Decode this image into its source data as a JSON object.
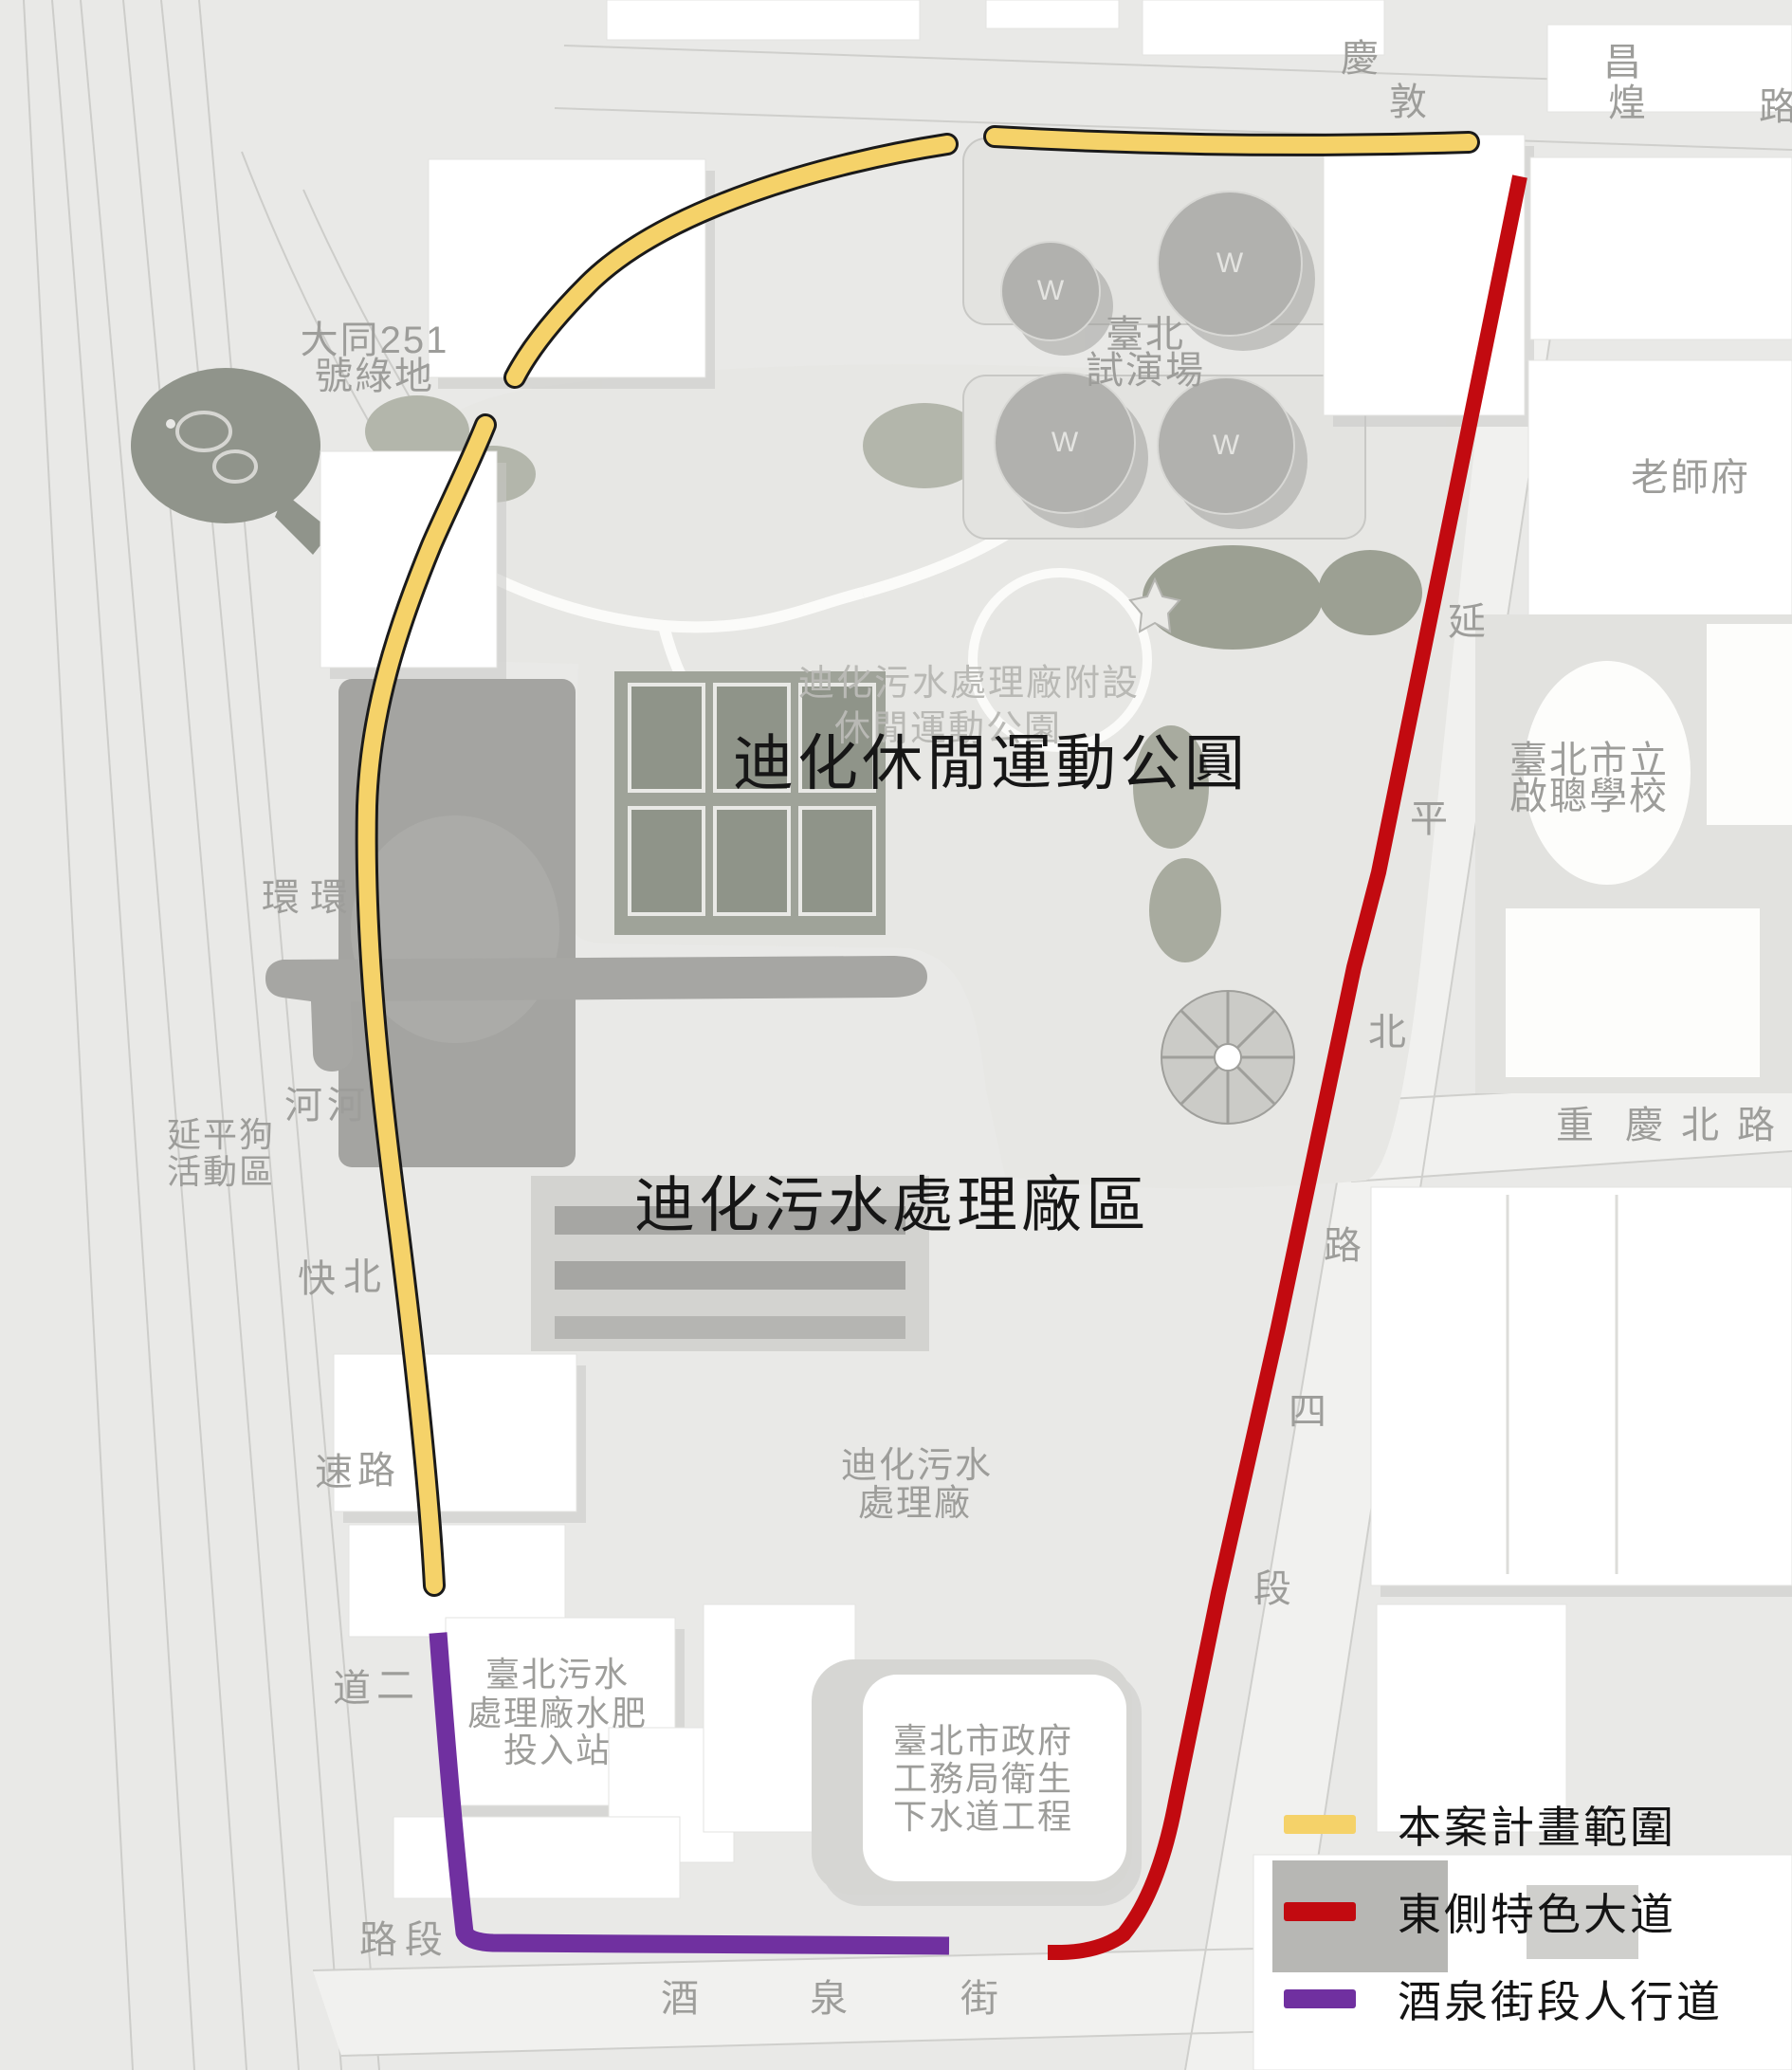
{
  "titles": {
    "park_title": "迪化休閒運動公圓",
    "park_subtitle_line1": "迪化污水處理廠附設",
    "park_subtitle_line2": "休閒運動公園",
    "plant_title": "迪化污水處理廠區"
  },
  "labels": {
    "green_space_line1": "大同251",
    "green_space_line2": "號綠地",
    "test_site_line1": "臺北",
    "test_site_line2": "試演場",
    "teacher_house": "老師府",
    "school_line1": "臺北市立",
    "school_line2": "啟聰學校",
    "dog_area_line1": "延平狗",
    "dog_area_line2": "活動區",
    "plant_small_line1": "迪化污水",
    "plant_small_line2": "處理廠",
    "sludge_line1": "臺北污水",
    "sludge_line2": "處理廠水肥",
    "sludge_line3": "投入站",
    "gov_line1": "臺北市政府",
    "gov_line2": "工務局衛生",
    "gov_line3": "下水道工程",
    "w_mark": "W"
  },
  "streets": {
    "top_row1": [
      "慶",
      "昌"
    ],
    "top_row2": [
      "敦",
      "煌",
      "路"
    ],
    "expressway_col": [
      "環",
      "河",
      "快",
      "速",
      "道",
      "路"
    ],
    "huanhe_north_col": [
      "環",
      "河",
      "北",
      "路",
      "二",
      "段"
    ],
    "yanping_col": [
      "延",
      "平",
      "北",
      "路",
      "四",
      "段"
    ],
    "chongqing_row": [
      "重",
      "慶",
      "北",
      "路"
    ],
    "jiuquan_row": [
      "酒",
      "泉",
      "街"
    ]
  },
  "legend": {
    "items": [
      {
        "label": "本案計畫範圍",
        "color": "#f5d269"
      },
      {
        "label": "東側特色大道",
        "color": "#c20a10"
      },
      {
        "label": "酒泉街段人行道",
        "color": "#7030a0"
      }
    ]
  },
  "colors": {
    "plan_route": "#f5d269",
    "east_avenue": "#c20a10",
    "jiuquan_walk": "#7030a0"
  }
}
